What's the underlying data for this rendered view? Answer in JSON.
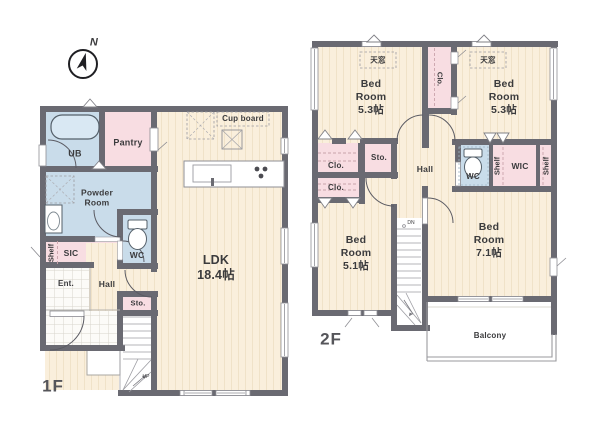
{
  "compass": {
    "north_label": "N"
  },
  "floor1": {
    "title": "1F",
    "rooms": {
      "ub": "UB",
      "pantry": "Pantry",
      "powder_room": "Powder\nRoom",
      "cupboard": "Cup board",
      "ldk": "LDK\n18.4帖",
      "shelf": "Shelf",
      "sic": "SIC",
      "wc": "WC",
      "entrance": "Ent.",
      "hall": "Hall",
      "storage": "Sto.",
      "stairs_up": "UP"
    }
  },
  "floor2": {
    "title": "2F",
    "rooms": {
      "skylight_left": "天窓",
      "skylight_right": "天窓",
      "bedroom_nw": "Bed\nRoom\n5.3帖",
      "bedroom_ne": "Bed\nRoom\n5.3帖",
      "bedroom_sw": "Bed\nRoom\n5.1帖",
      "bedroom_se": "Bed\nRoom\n7.1帖",
      "closet_between_bedrooms": "Clo.",
      "closet_upper": "Clo.",
      "closet_lower": "Clo.",
      "storage": "Sto.",
      "hall": "Hall",
      "wc": "WC",
      "shelf_left": "Shelf",
      "shelf_right": "Shelf",
      "wic": "WIC",
      "stairs_down": "DN",
      "balcony": "Balcony"
    }
  },
  "colors": {
    "wall": "#6a6a72",
    "floor_wood": "#faefdc",
    "wet_area_blue": "#c9dcea",
    "storage_pink": "#f8dde2"
  }
}
